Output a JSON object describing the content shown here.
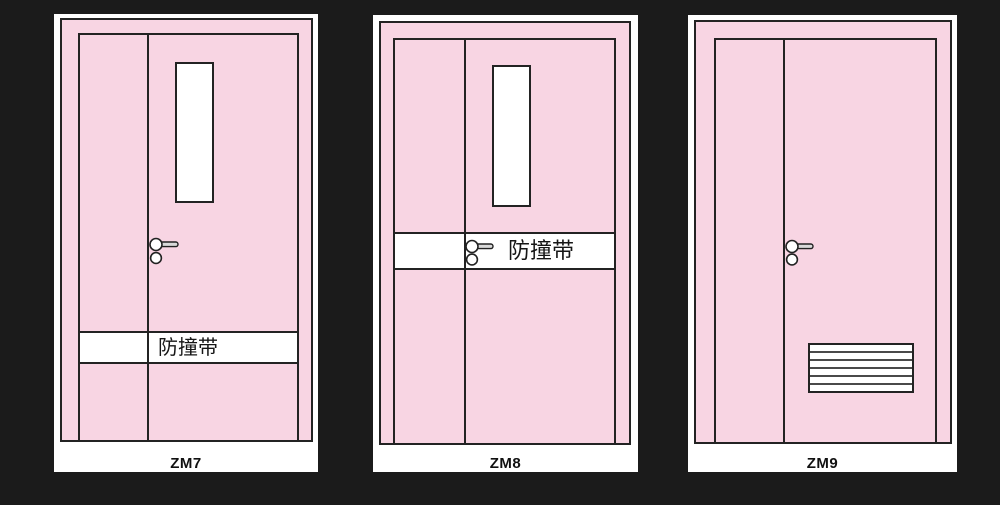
{
  "figure_type": "door-elevation-drawings",
  "doors": [
    {
      "code": "ZM7",
      "band_label": "防撞带"
    },
    {
      "code": "ZM8",
      "band_label": "防撞带"
    },
    {
      "code": "ZM9"
    }
  ],
  "colors": {
    "background": "#1b1b1b",
    "door_fill": "#f8d5e3",
    "outline": "#232323",
    "panel": "#ffffff",
    "slat_line": "#4a4a4a"
  }
}
